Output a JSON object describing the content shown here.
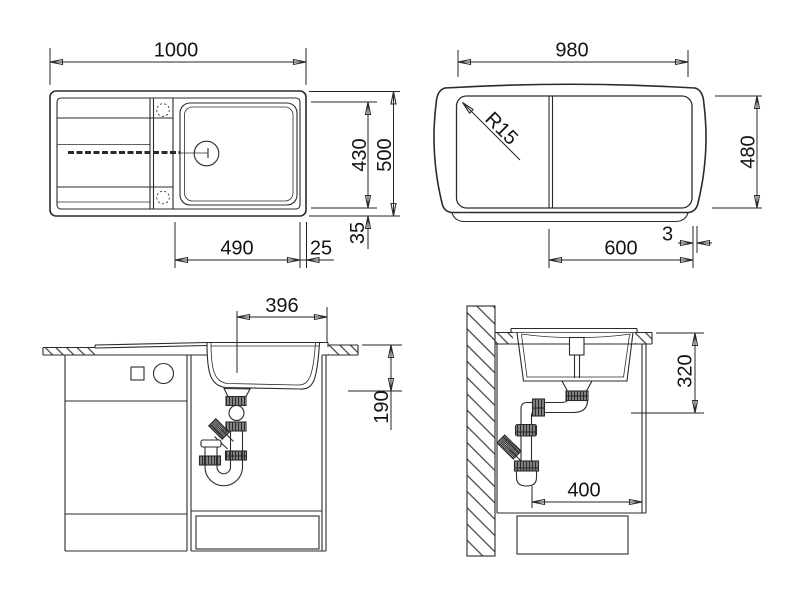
{
  "dims": {
    "top_view": {
      "width": "1000",
      "depth": "500",
      "bowl_depth": "430",
      "bowl_width": "490",
      "rim_right": "25",
      "rim_bottom": "35"
    },
    "underside_view": {
      "width": "980",
      "corner_radius": "R15",
      "depth": "480",
      "drain_offset": "600",
      "edge_gap": "3"
    },
    "front_view": {
      "bowl_width": "396",
      "bowl_depth": "190"
    },
    "side_view": {
      "mount_depth": "320",
      "base_clearance": "400"
    }
  },
  "colors": {
    "line": "#2b2b2b",
    "text": "#141414",
    "background": "#ffffff"
  }
}
